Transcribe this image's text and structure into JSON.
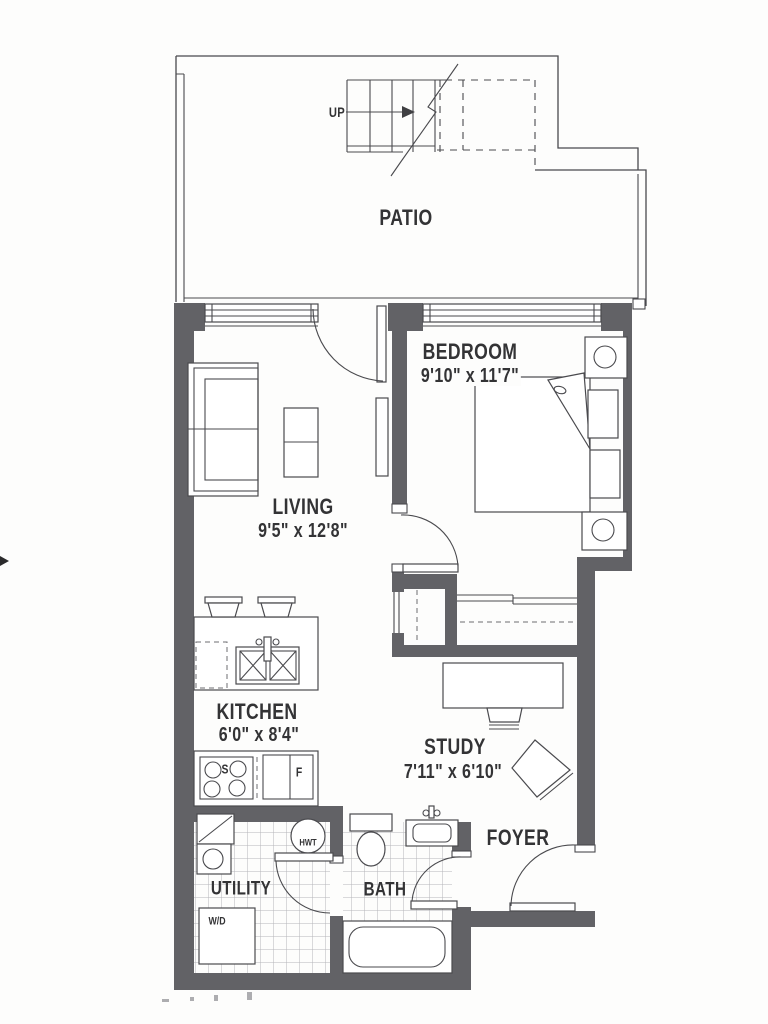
{
  "title": "apartment-floor-plan",
  "labels": {
    "patio": "PATIO",
    "up": "UP",
    "bedroom": "BEDROOM",
    "bedroom_dims": "9'10\" x 11'7\"",
    "living": "LIVING",
    "living_dims": "9'5\" x 12'8\"",
    "kitchen": "KITCHEN",
    "kitchen_dims": "6'0\" x 8'4\"",
    "study": "STUDY",
    "study_dims": "7'11\" x 6'10\"",
    "foyer": "FOYER",
    "utility": "UTILITY",
    "bath": "BATH",
    "washer_dryer": "W/D",
    "hot_water_tank": "HWT",
    "stove": "S",
    "fridge": "F"
  },
  "colors": {
    "wall": "#626266",
    "line": "#4a4a4e",
    "tile_line": "#b5b5ba",
    "text": "#333335",
    "paper": "#fdfdfc"
  }
}
